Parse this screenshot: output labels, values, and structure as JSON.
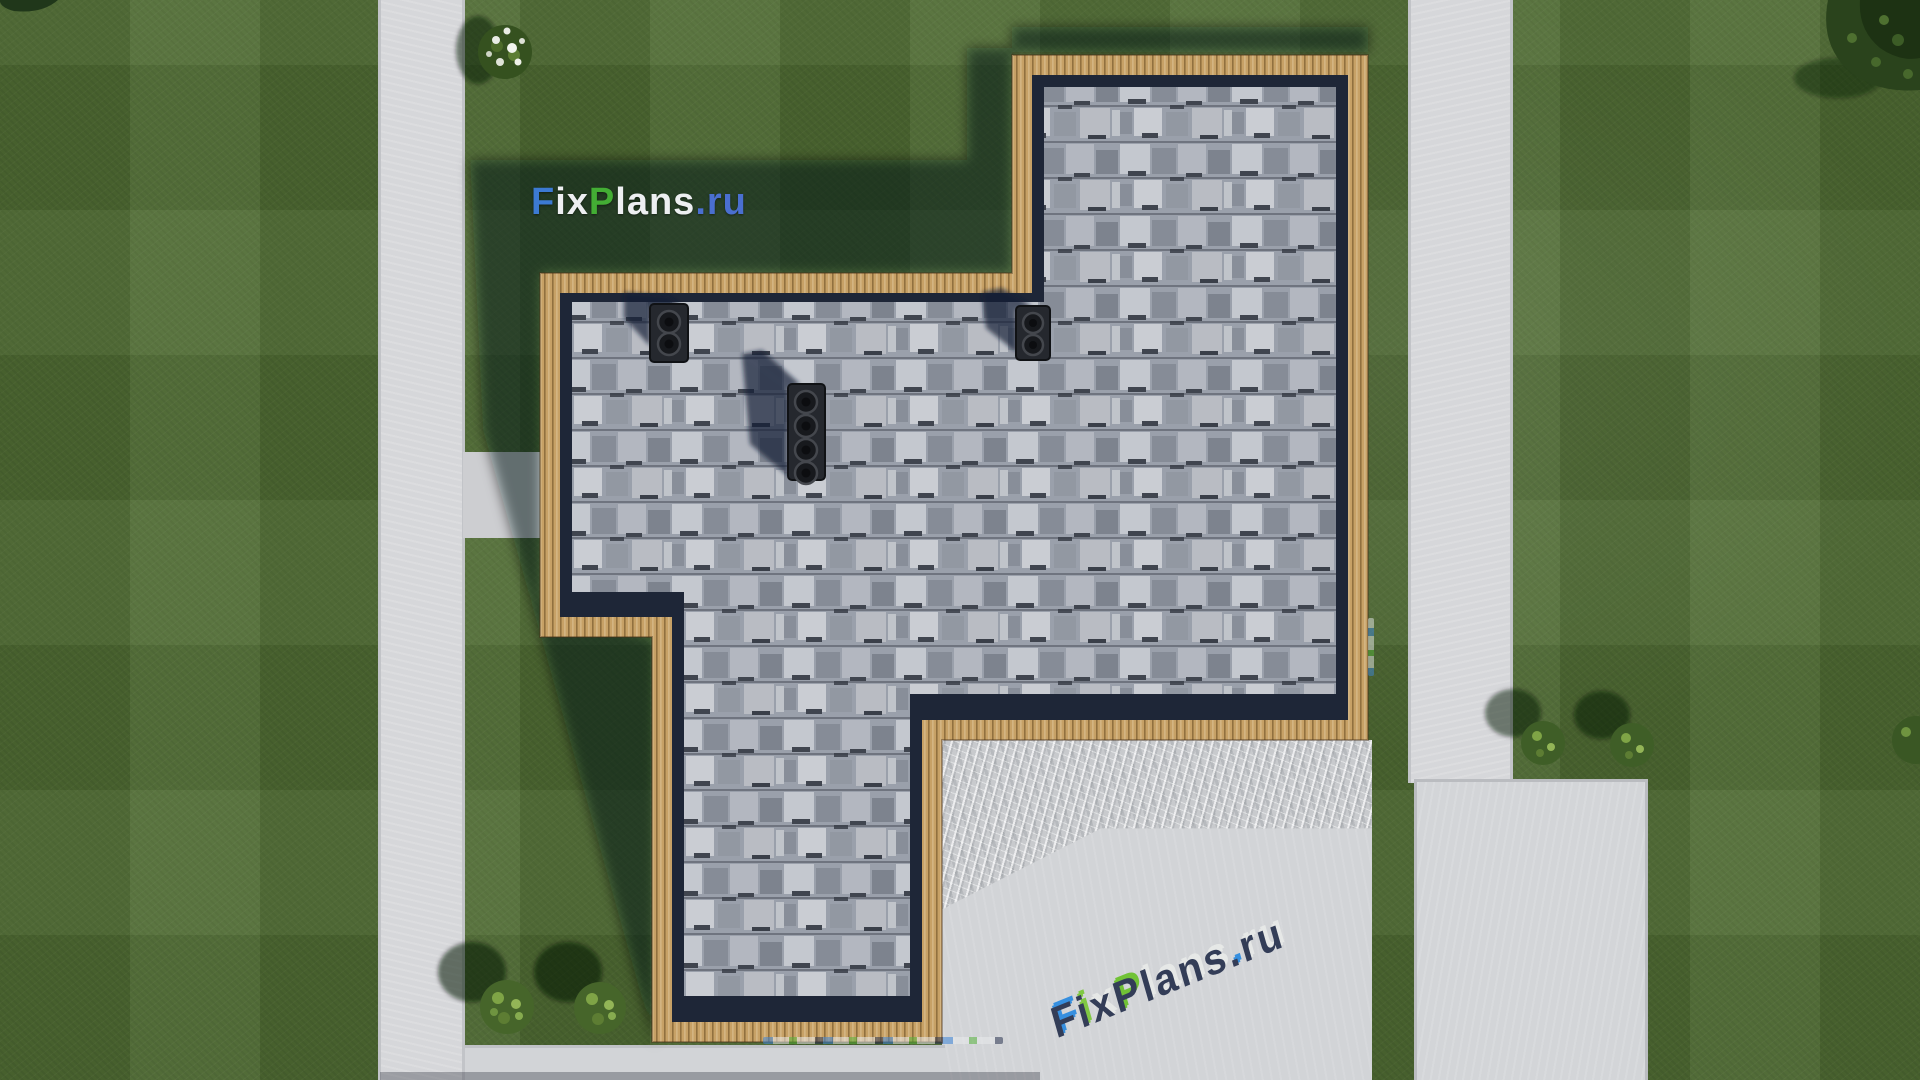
{
  "scene": {
    "type": "aerial-3d-render",
    "description": "Top-down 3D architectural rendering: gray shingle roof of an irregular-plan house with wooden eave trim, roof vents, lawn, concrete walkways, driveway and shrubs",
    "watermark_top": {
      "text": "FixPlans.ru",
      "segments": [
        {
          "text": "F",
          "color": "#3c7ad2"
        },
        {
          "text": "ix",
          "color": "#edeff1"
        },
        {
          "text": "P",
          "color": "#43ad34"
        },
        {
          "text": "lans",
          "color": "#edeff1"
        },
        {
          "text": ".ru",
          "color": "#4a6fd0"
        }
      ]
    },
    "watermark_bottom": {
      "text": "FixPlans.ru",
      "body_color": "#2b3551",
      "letters": [
        {
          "ch": "F",
          "cap": "#2e8ce0"
        },
        {
          "ch": "i",
          "cap": "#7cc83c"
        },
        {
          "ch": "x",
          "cap": "#e8eae8"
        },
        {
          "ch": "P",
          "cap": "#6cc22e"
        },
        {
          "ch": "l",
          "cap": "#e8eae8"
        },
        {
          "ch": "a",
          "cap": "#e8eae8"
        },
        {
          "ch": "n",
          "cap": "#e8eae8"
        },
        {
          "ch": "s",
          "cap": "#e8eae8"
        },
        {
          "ch": ".",
          "cap": "#2e8ce0"
        },
        {
          "ch": "r",
          "cap": "#e8eae8"
        },
        {
          "ch": "u",
          "cap": "#e8eae8"
        }
      ]
    },
    "palette": {
      "grass": "#4f6b33",
      "grass_shadow": "rgba(12,20,14,0.52)",
      "concrete_path": "#d6d7da",
      "concrete_driveway": "#c8cacd",
      "wood_trim": "#c7a166",
      "wood_stripe": "#91703f",
      "roof_eave_navy": "#1e2637",
      "shingle_base": "#9aa0ab",
      "shingle_light": "#c9ccd2",
      "shingle_dark": "#7d838e",
      "vent_body": "#25282e",
      "bush_green": "#46652a",
      "tree_green": "#2a431c"
    },
    "elements": {
      "roof": "gray shingle roof with wooden trim border",
      "vents": "three dark roof vent blocks (2, 4 and 2 round flues)",
      "paths": "left vertical walkway, right vertical walkway, bottom strip, right concrete pad, patio and streaked driveway",
      "plants": "white flowering shrub, four round green shrubs, corner tree canopies"
    }
  }
}
